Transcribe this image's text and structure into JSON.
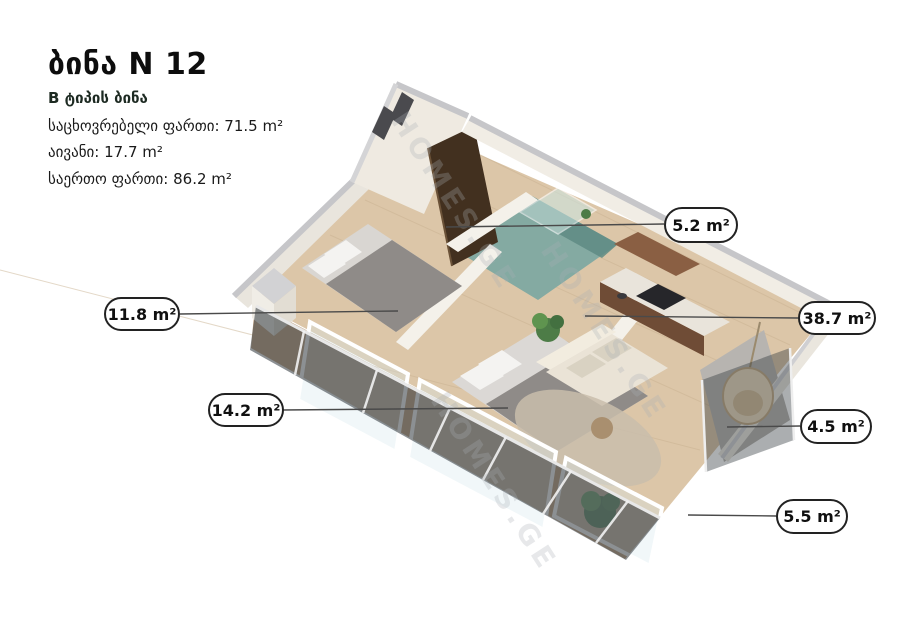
{
  "header": {
    "title": "ბინა N 12",
    "subtitle": "B ტიპის ბინა",
    "info_lines": [
      "საცხოვრებელი ფართი: 71.5 m²",
      "აივანი: 17.7 m²",
      "საერთო ფართი: 86.2 m²"
    ]
  },
  "floor_plan": {
    "type": "isometric-3d-apartment-render",
    "watermark": "HOMES.GE",
    "rooms": [
      {
        "name": "bathroom",
        "area": "5.2 m²"
      },
      {
        "name": "bedroom-1",
        "area": "11.8 m²"
      },
      {
        "name": "living-room-kitchen",
        "area": "38.7 m²"
      },
      {
        "name": "bedroom-2",
        "area": "14.2 m²"
      },
      {
        "name": "balcony-right",
        "area": "4.5 m²"
      },
      {
        "name": "balcony-bottom",
        "area": "5.5 m²"
      }
    ]
  },
  "palette": {
    "label_border": "#222222",
    "wall_cream": "#f1ede5",
    "wall_cap_gray": "#c6c6c9",
    "floor_wood": "#d8c2a4",
    "balcony_wood": "#c9ad8e",
    "bathroom_teal": "#84aaa2",
    "glass_dark": "#31373d",
    "door_brown": "#42301f",
    "kitchen_brown": "#6f4c36",
    "plant_green": "#4d7c47"
  }
}
